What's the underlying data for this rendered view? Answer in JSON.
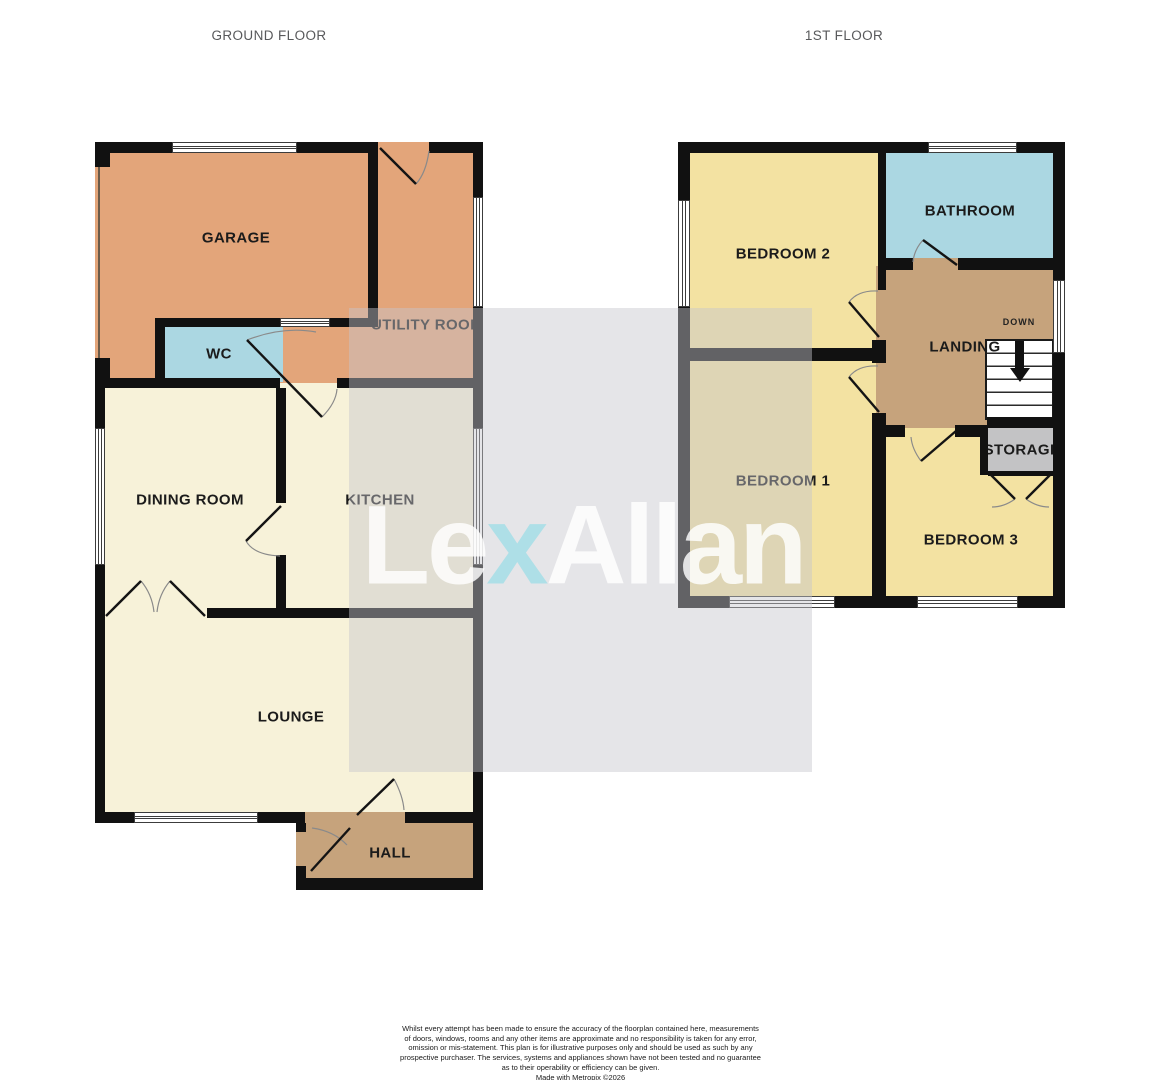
{
  "floorplan": {
    "titles": {
      "ground": "GROUND FLOOR",
      "first": "1ST FLOOR"
    },
    "rooms": {
      "garage": "GARAGE",
      "utility": "UTILITY ROOM",
      "wc": "WC",
      "dining": "DINING ROOM",
      "kitchen": "KITCHEN",
      "lounge": "LOUNGE",
      "hall": "HALL",
      "bedroom2": "BEDROOM 2",
      "bathroom": "BATHROOM",
      "landing": "LANDING",
      "down": "DOWN",
      "bedroom1": "BEDROOM 1",
      "storage": "STORAGE",
      "bedroom3": "BEDROOM 3"
    },
    "colors": {
      "garage_tan": "#e3a57a",
      "wet_room_blue": "#abd7e2",
      "living_cream": "#f7f2d9",
      "bedroom_yellow": "#f3e2a2",
      "hall_tan": "#c6a37c",
      "storage_grey": "#c3c3c5",
      "wall_black": "#111111",
      "watermark_grey": "#e4e4e6",
      "watermark_accent": "#a5dee6"
    },
    "watermark": {
      "le": "Le",
      "x": "x",
      "allan": "Allan"
    },
    "disclaimer": {
      "lines": [
        "Whilst every attempt has been made to ensure the accuracy of the floorplan contained here, measurements",
        "of doors, windows, rooms and any other items are approximate and no responsibility is taken for any error,",
        "omission or mis-statement. This plan is for illustrative purposes only and should be used as such by any",
        "prospective purchaser. The services, systems and appliances shown have not been tested and no guarantee",
        "as to their operability or efficiency can be given.",
        "Made with Metropix ©2026"
      ]
    }
  }
}
